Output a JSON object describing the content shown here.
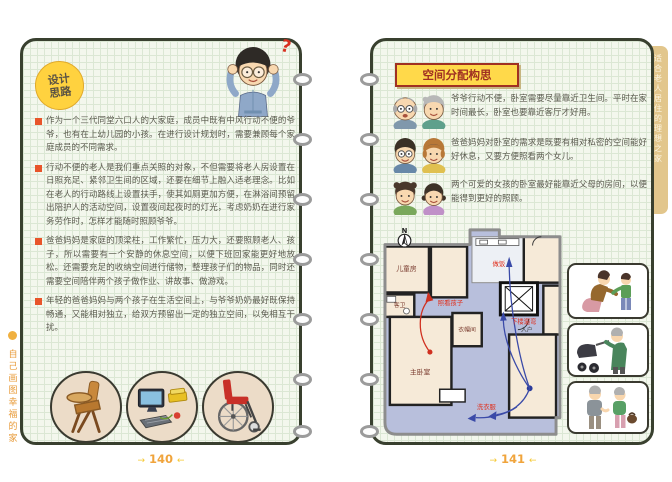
{
  "spread": {
    "left_page": {
      "side_label": "自己画图幸福的家",
      "badge": {
        "line1": "设计",
        "line2": "思路"
      },
      "question_mark": "?",
      "notes": [
        "作为一个三代同堂六口人的大家庭，成员中既有中风行动不便的爷爷，也有在上幼儿园的小孩。在进行设计规划时，需要兼顾每个家庭成员的不同需求。",
        "行动不便的老人是我们重点关照的对象，不但需要将老人房设置在日照充足、紧邻卫生间的区域，还要在细节上融入适老理念。比如在老人的行动路线上设置扶手，使其如厕更加方便，在淋浴间预留出陪护人的活动空间，设置夜间起夜时的灯光，考虑奶奶在进行家务劳作时，怎样才能随时照顾爷爷。",
        "爸爸妈妈是家庭的顶梁柱，工作繁忙，压力大，还要照顾老人、孩子，所以需要有一个安静的休息空间，以便下班回家能更好地放松。还需要充足的收纳空间进行储物，整理孩子们的物品，同时还需要空间陪伴两个孩子做作业、讲故事、做游戏。",
        "年轻的爸爸妈妈与两个孩子在生活空间上，与爷爷奶奶最好既保持畅通，又能相对独立，给双方预留出一定的独立空间，以免相互干扰。"
      ],
      "bottom_icons": [
        "baby-high-chair",
        "computer-desk",
        "wheelchair"
      ],
      "page_number": "140"
    },
    "right_page": {
      "section_title": "空间分配构思",
      "ideas": [
        {
          "who": "grandpa-grandma",
          "text": "爷爷行动不便，卧室需要尽量靠近卫生间。平时在家时间最长，卧室也要靠近客厅才好用。"
        },
        {
          "who": "dad-mom",
          "text": "爸爸妈妈对卧室的需求是既要有相对私密的空间能好好休息，又要方便照看两个女儿。"
        },
        {
          "who": "two-girls",
          "text": "两个可爱的女孩的卧室最好能靠近父母的房间，以便能得到更好的照顾。"
        }
      ],
      "floorplan": {
        "compass": "N",
        "rooms": [
          "儿童房",
          "客卫",
          "衣帽间",
          "主卧室"
        ],
        "entry_label": "入户",
        "annotations": [
          "照看孩子",
          "做饭",
          "下楼遛弯",
          "洗衣服"
        ]
      },
      "photo_icons": [
        "mother-with-child",
        "elder-pushing-stroller",
        "elderly-couple-walking"
      ],
      "side_tab": "适合老人居住的理想之家",
      "page_number": "141"
    },
    "footer": {
      "lead_arrow": "→",
      "tail_arrow": "←"
    },
    "colors": {
      "page_bg": "#f3f7ed",
      "grid_line": "#dbe7d4",
      "border": "#39402f",
      "badge_yellow": "#ffd23f",
      "title_red": "#a03022",
      "bullet_orange": "#e8542a",
      "hall_lavender": "#b8bfdc",
      "room_cream": "#f6ead8",
      "annotation_red": "#e0301e",
      "route_blue": "#3a4aa8",
      "page_number_orange": "#f0a43c"
    }
  }
}
